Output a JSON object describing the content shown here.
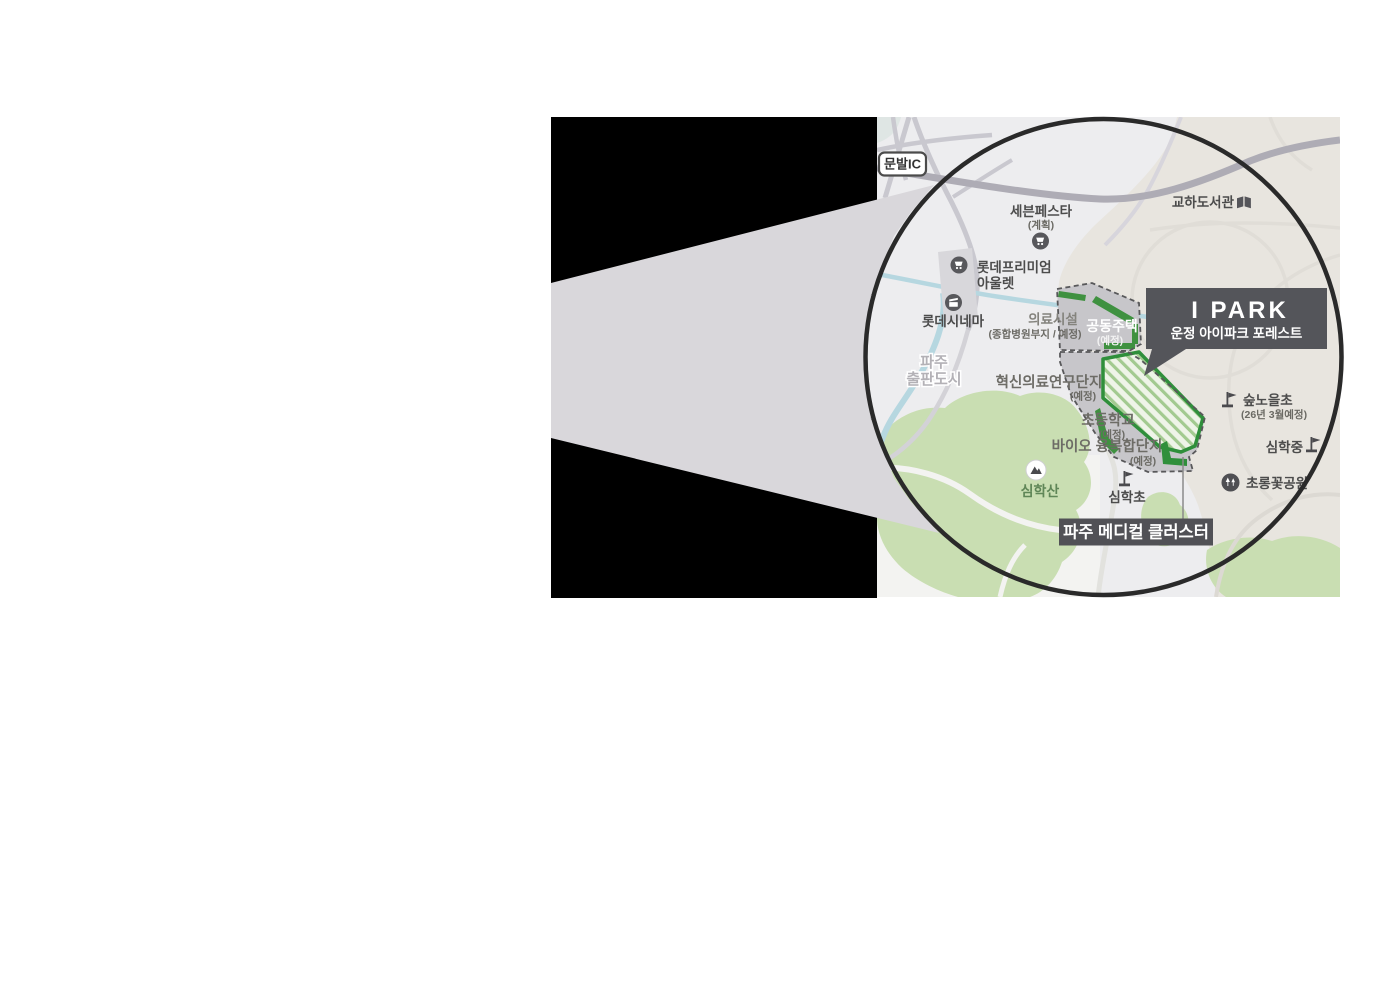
{
  "map": {
    "badge_munbal": "문발IC",
    "labels": {
      "seven_festa": "세븐페스타",
      "seven_festa_sub": "(계획)",
      "gyoha_library": "교하도서관",
      "lotte_premium1": "롯데프리미엄",
      "lotte_premium2": "아울렛",
      "lotte_cinema": "롯데시네마",
      "paju1": "파주",
      "paju2": "출판도시",
      "medical_facility": "의료시설",
      "medical_facility_sub": "(종합병원부지 / 예정)",
      "housing": "공동주택",
      "housing_sub": "(예정)",
      "research": "혁신의료연구단지",
      "research_sub": "(예정)",
      "elementary": "초등학교",
      "elementary_sub": "(예정)",
      "bio": "바이오 융복합단지",
      "bio_sub": "(예정)",
      "simhaksan": "심학산",
      "simhakcho": "심학초",
      "supnoeul": "숲노을초",
      "supnoeul_sub": "(26년 3월예정)",
      "simhakjung": "심학중",
      "chorong": "초롱꽃공원"
    },
    "callouts": {
      "ipark_title": "I PARK",
      "ipark_sub": "운정 아이파크 포레스트",
      "medical_cluster": "파주 메디컬 클러스터"
    },
    "icons": {
      "cart": "shopping-cart-icon",
      "cinema": "clapperboard-icon",
      "book": "book-icon",
      "mountain": "mountain-icon",
      "flag": "flag-icon",
      "trees": "park-trees-icon"
    },
    "colors": {
      "site_border_green": "#2f8f3b",
      "building_green": "#3f9140",
      "hatch_stripe": "#a2ca90",
      "hatch_bg": "#eef4e8",
      "district_gray": "#c7c6ca",
      "badge_dark": "#54555a",
      "beam_gray": "#d9d7db",
      "park_green": "#c9deb2",
      "river_blue": "#b6d7e0",
      "highway_gray": "#aeacb5",
      "beige": "#e8e5df",
      "map_base": "#ededef"
    }
  }
}
